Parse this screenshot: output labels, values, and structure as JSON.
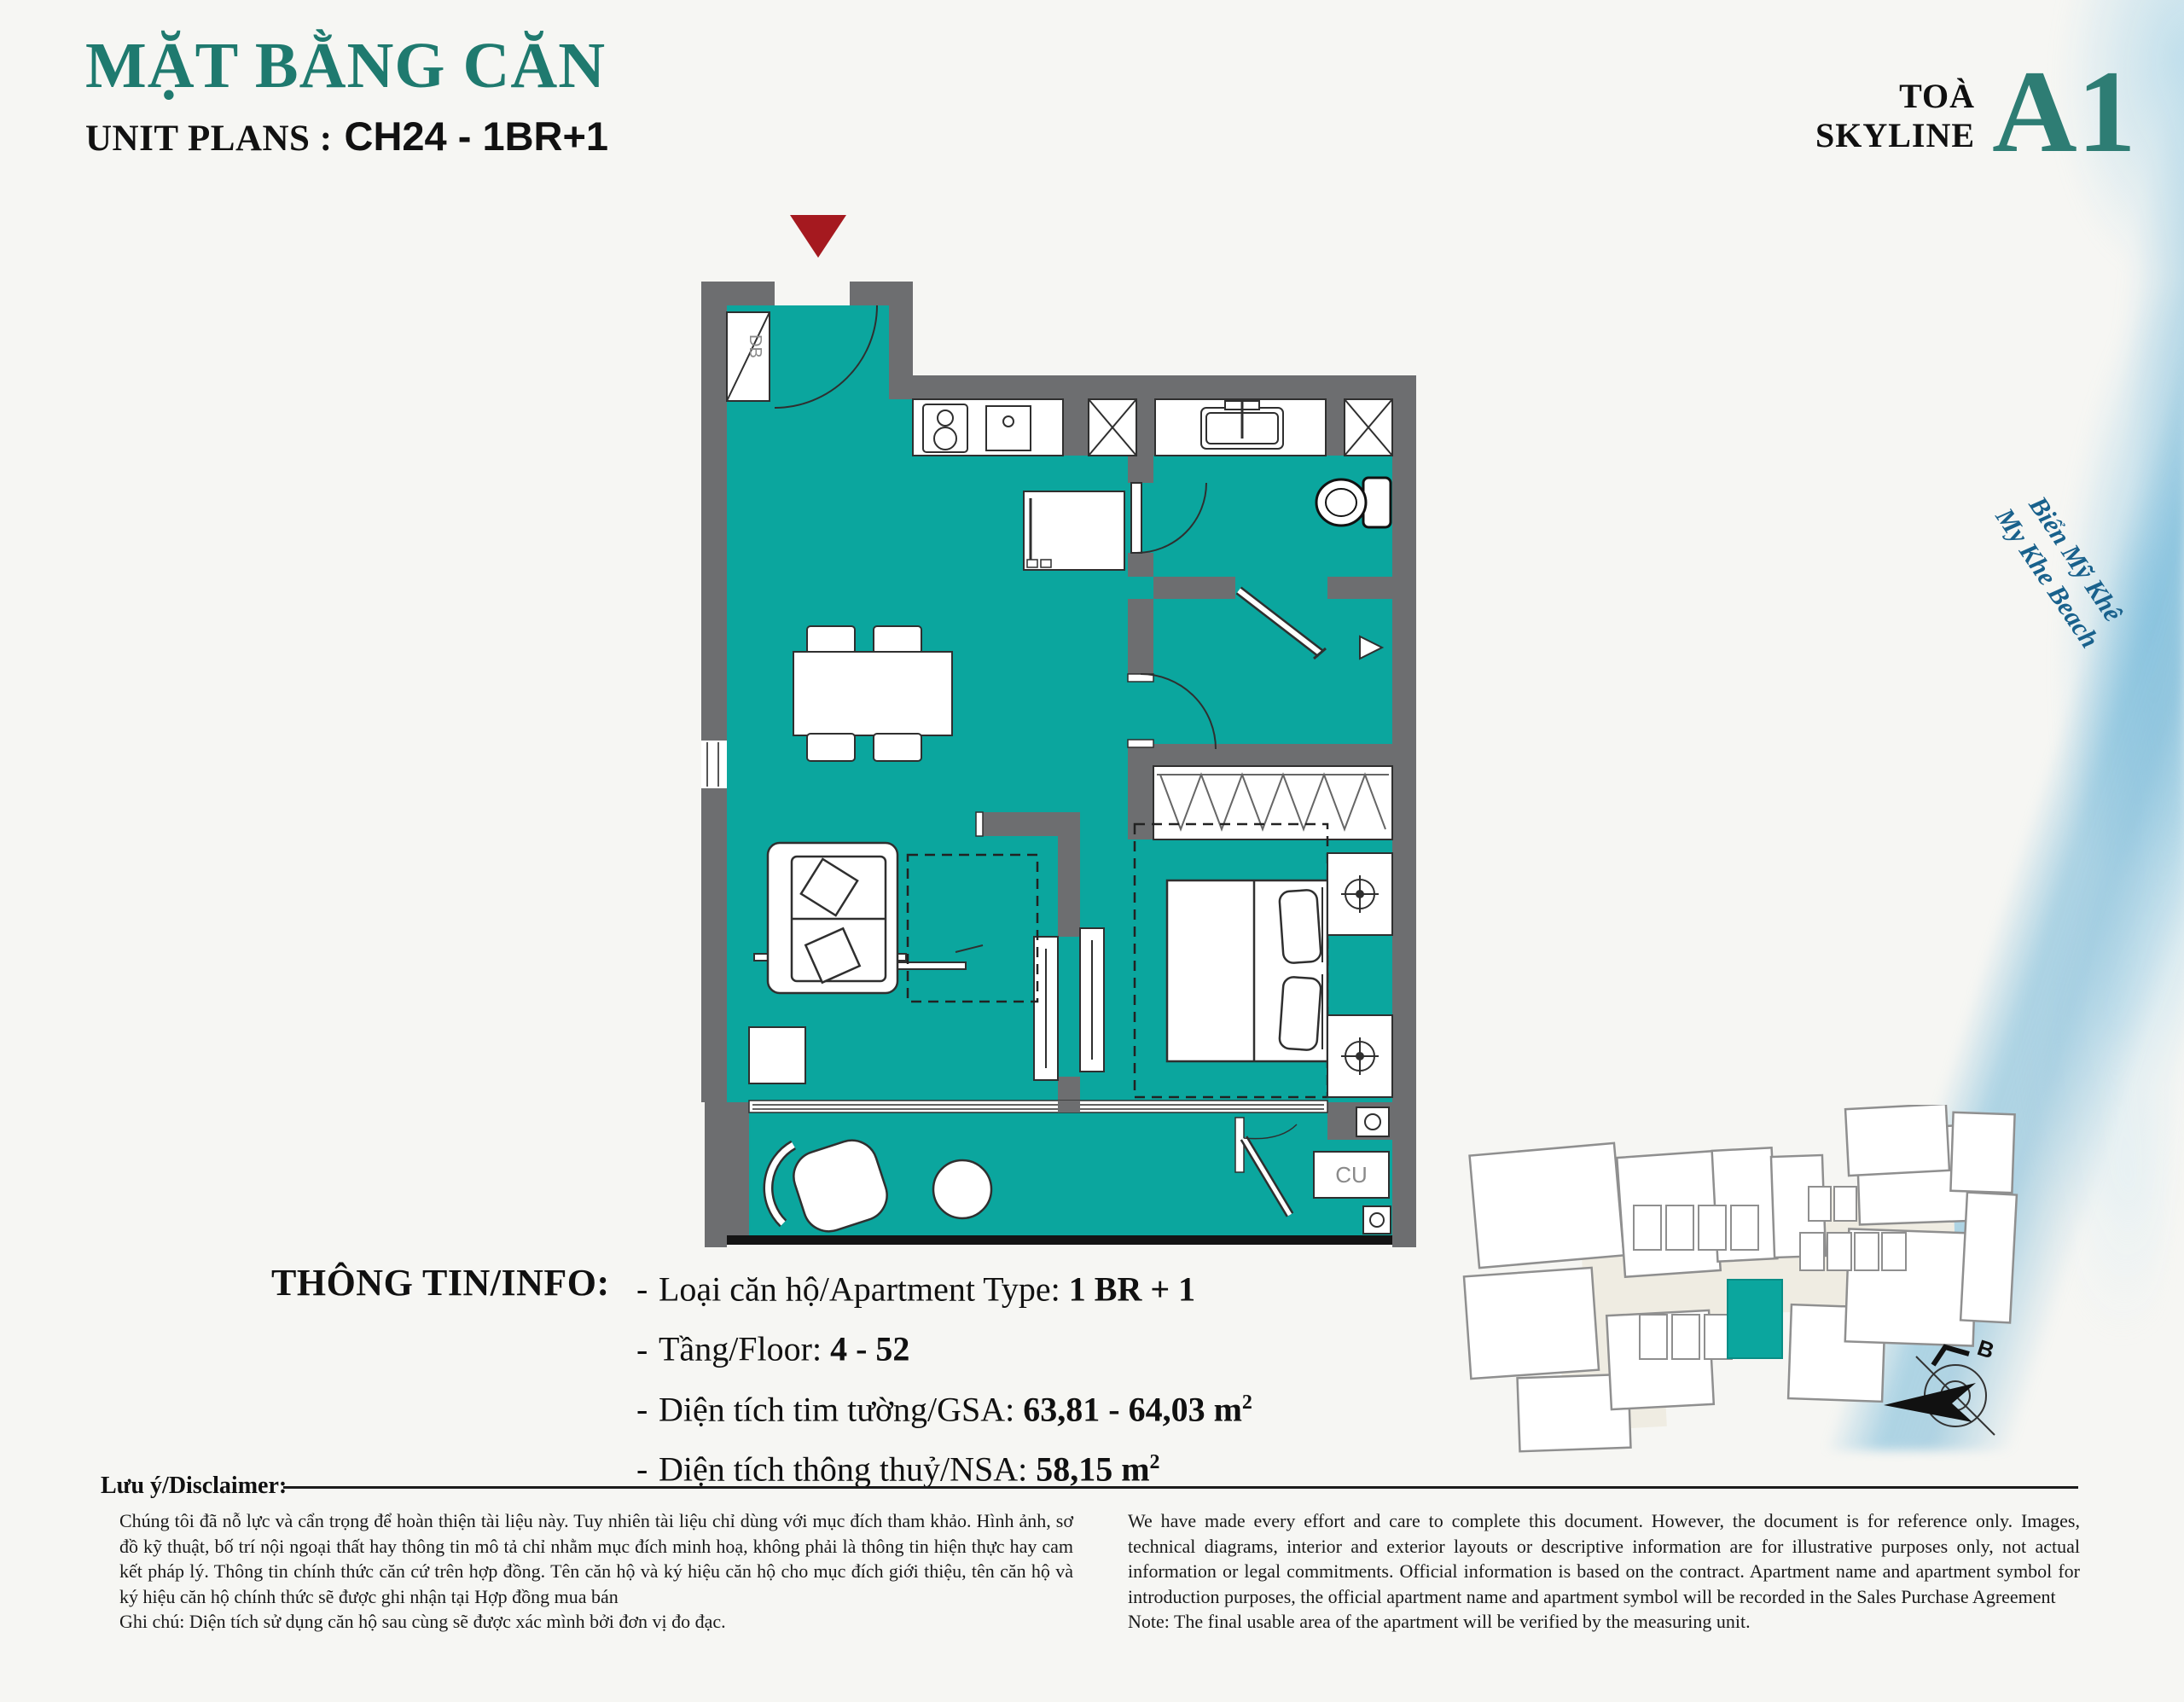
{
  "header": {
    "title": "MẶT BẰNG CĂN",
    "unit_label": "UNIT PLANS :",
    "unit_value": "CH24 - 1BR+1"
  },
  "tower": {
    "label_line1": "TOÀ",
    "label_line2": "SKYLINE",
    "code": "A1"
  },
  "beach": {
    "line1": "Biển Mỹ Khê",
    "line2": "My Khe Beach"
  },
  "floorplan": {
    "db_label": "DB",
    "cu_label": "CU",
    "floor_color": "#0ba69e",
    "wall_color": "#6d6e70",
    "entry_marker_color": "#a5191f"
  },
  "siteplan": {
    "north_label": "B",
    "highlight_color": "#0ba69e"
  },
  "info": {
    "heading": "THÔNG TIN/INFO:",
    "bullet": "-",
    "items": [
      {
        "label": "Loại căn hộ/Apartment Type: ",
        "value": "1 BR + 1",
        "sup": ""
      },
      {
        "label": "Tầng/Floor: ",
        "value": "4 - 52",
        "sup": ""
      },
      {
        "label": "Diện tích tim tường/GSA: ",
        "value": "63,81 - 64,03 m",
        "sup": "2"
      },
      {
        "label": "Diện tích thông thuỷ/NSA: ",
        "value": "58,15 m",
        "sup": "2"
      }
    ]
  },
  "disclaimer": {
    "heading": "Lưu ý/Disclaimer:",
    "vi": "Chúng tôi đã nỗ lực và cẩn trọng để hoàn thiện tài liệu này. Tuy nhiên tài liệu chỉ dùng với mục đích tham khảo. Hình ảnh, sơ đồ kỹ thuật, bố trí nội ngoại thất hay thông tin mô tả chỉ nhằm mục đích minh hoạ, không phải là thông tin hiện thực hay cam kết pháp lý. Thông tin chính thức căn cứ trên hợp đồng. Tên căn hộ và ký hiệu căn hộ cho mục đích giới thiệu, tên căn hộ và ký hiệu căn hộ chính thức sẽ được ghi nhận tại Hợp đồng mua bán",
    "vi_note": "Ghi chú: Diện tích sử dụng căn hộ sau cùng sẽ được xác mình bởi đơn vị đo đạc.",
    "en": "We have made every effort and care to complete this document. However, the document is for reference only. Images, technical diagrams, interior and exterior layouts or descriptive information are for illustrative purposes only, not actual information or legal commitments. Official information is based on the contract. Apartment name and apartment symbol for introduction purposes, the official apartment name and apartment symbol will be recorded in the Sales Purchase Agreement",
    "en_note": "Note: The final usable area of the apartment will be verified by the measuring unit."
  }
}
